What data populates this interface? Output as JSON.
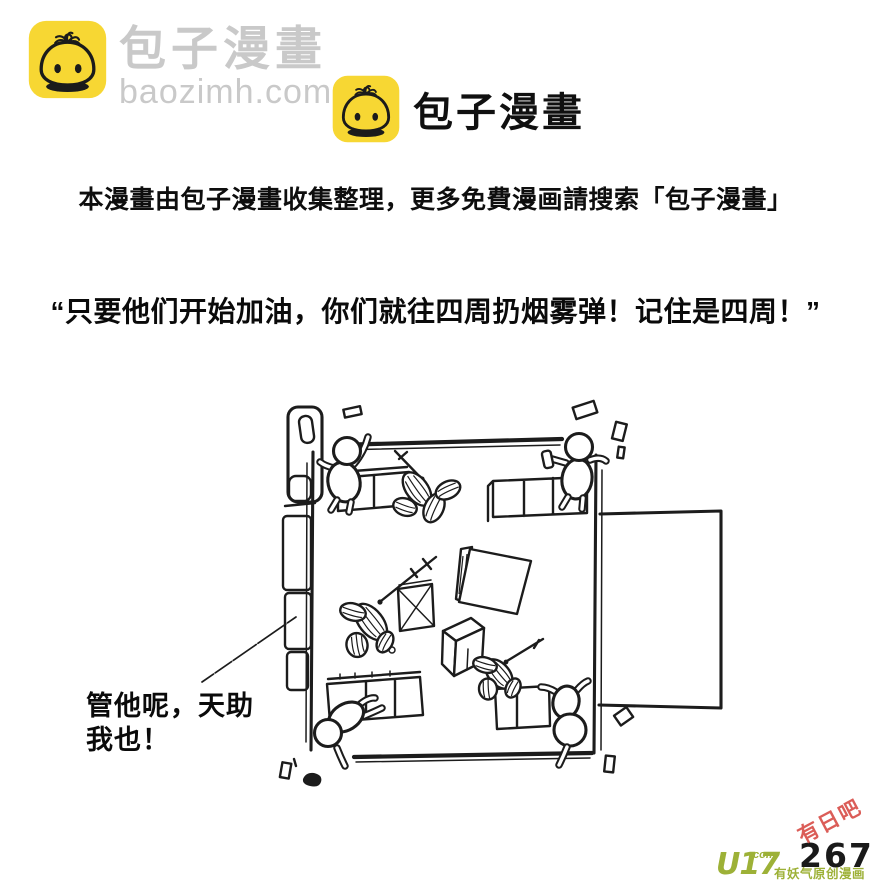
{
  "page": {
    "background": "#ffffff"
  },
  "branding": {
    "corner": {
      "name": "包子漫畫",
      "domain": "baozimh.com",
      "text_color": "#c9c9c9"
    },
    "center": {
      "name": "包子漫畫"
    },
    "logo": {
      "square_color": "#f7d733",
      "line_color": "#1b1b1b"
    }
  },
  "notice": {
    "text": "本漫畫由包子漫畫收集整理，更多免費漫画請搜索「包子漫畫」"
  },
  "dialogue": {
    "narration": "“只要他们开始加油，你们就往四周扔烟雾弹！记住是四周！”",
    "speech": {
      "line1": "管他呢，天助",
      "line2": "我也！"
    }
  },
  "footer": {
    "page_number": "267",
    "publisher": {
      "logo": "U17",
      "suffix": ".com",
      "tagline": "有妖气原创漫画",
      "color": "#9db137"
    },
    "watermark": {
      "text": "有日吧",
      "color": "#d8504a"
    }
  }
}
